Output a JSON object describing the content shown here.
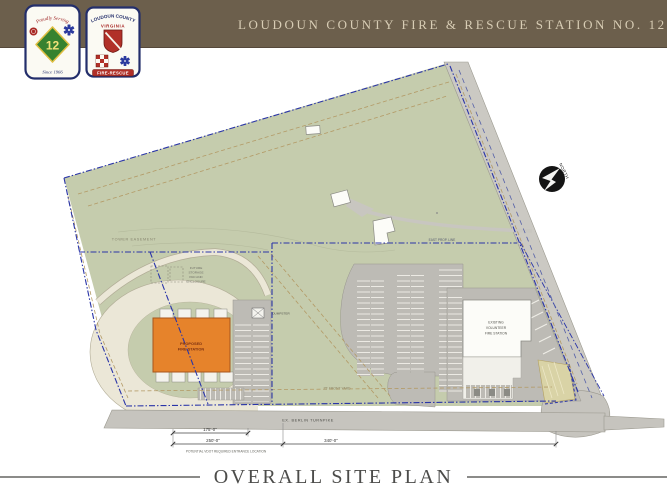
{
  "header": {
    "title": "LOUDOUN COUNTY FIRE & RESCUE STATION NO. 12"
  },
  "logos": {
    "station12": {
      "top": "Proudly Serving",
      "number": "12",
      "bottom": "Since 1966"
    },
    "county": {
      "top": "LOUDOUN COUNTY",
      "mid": "VIRGINIA",
      "banner": "FIRE-RESCUE"
    }
  },
  "plan": {
    "tower_easement": "TOWER EASEMENT",
    "future_storage": {
      "l1": "FUTURE",
      "l2": "STORAGE",
      "l3": "PAD AND",
      "l4": "ENCLOSURE"
    },
    "dumpster": "DUMPSTER",
    "proposed": {
      "l1": "PROPOSED",
      "l2": "FIRE STATION"
    },
    "existing": {
      "l1": "EXISTING",
      "l2": "VOLUNTEER",
      "l3": "FIRE STATION"
    },
    "east_prop_line": "EAST PROP. LINE",
    "front_yard": "25' FRONT YARD",
    "turnpike": "EX. BERLIN TURNPIKE",
    "north": "NORTH",
    "dims": {
      "d1": "175'-0\"",
      "d2": "250'-0\"",
      "d3": "340'-0\""
    },
    "vdot_note": "POTENTIAL VDOT REQUIRED ENTRANCE LOCATION"
  },
  "footer": {
    "title": "OVERALL SITE PLAN"
  },
  "colors": {
    "header_bg": "#6c5f4c",
    "header_text": "#d8cdb5",
    "field_green": "#c5ccad",
    "road_gray": "#c6c4be",
    "parking_gray": "#bdbbb5",
    "loop_cream": "#ebe7d7",
    "proposed_building_orange": "#e6832b",
    "property_line_blue": "#2a35a8",
    "setback_tan": "#b39a66",
    "khaki_parcel": "#d9d3a6"
  }
}
